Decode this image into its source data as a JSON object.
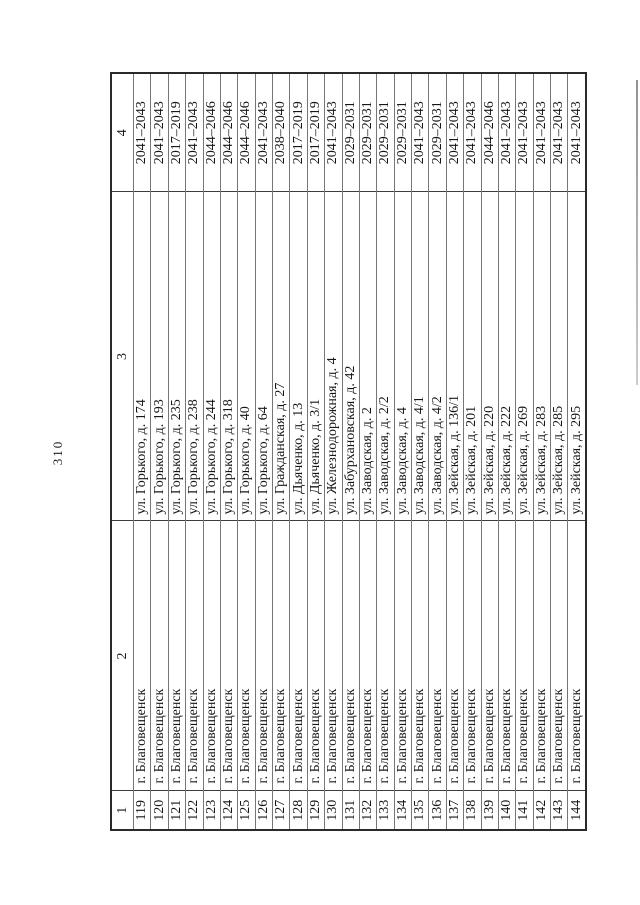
{
  "page": {
    "number": "310"
  },
  "table": {
    "column_numbers": [
      "1",
      "2",
      "3",
      "4"
    ],
    "rows": [
      {
        "num": "119",
        "city": "г. Благовещенск",
        "address": "ул. Горького, д. 174",
        "years": "2041–2043"
      },
      {
        "num": "120",
        "city": "г. Благовещенск",
        "address": "ул. Горького, д. 193",
        "years": "2041–2043"
      },
      {
        "num": "121",
        "city": "г. Благовещенск",
        "address": "ул. Горького, д. 235",
        "years": "2017–2019"
      },
      {
        "num": "122",
        "city": "г. Благовещенск",
        "address": "ул. Горького, д. 238",
        "years": "2041–2043"
      },
      {
        "num": "123",
        "city": "г. Благовещенск",
        "address": "ул. Горького, д. 244",
        "years": "2044–2046"
      },
      {
        "num": "124",
        "city": "г. Благовещенск",
        "address": "ул. Горького, д. 318",
        "years": "2044–2046"
      },
      {
        "num": "125",
        "city": "г. Благовещенск",
        "address": "ул. Горького, д. 40",
        "years": "2044–2046"
      },
      {
        "num": "126",
        "city": "г. Благовещенск",
        "address": "ул. Горького, д. 64",
        "years": "2041–2043"
      },
      {
        "num": "127",
        "city": "г. Благовещенск",
        "address": "ул. Гражданская, д. 27",
        "years": "2038–2040"
      },
      {
        "num": "128",
        "city": "г. Благовещенск",
        "address": "ул. Дьяченко, д. 13",
        "years": "2017–2019"
      },
      {
        "num": "129",
        "city": "г. Благовещенск",
        "address": "ул. Дьяченко, д. 3/1",
        "years": "2017–2019"
      },
      {
        "num": "130",
        "city": "г. Благовещенск",
        "address": "ул. Железнодорожная, д. 4",
        "years": "2041–2043"
      },
      {
        "num": "131",
        "city": "г. Благовещенск",
        "address": "ул. Забурхановская, д. 42",
        "years": "2029–2031"
      },
      {
        "num": "132",
        "city": "г. Благовещенск",
        "address": "ул. Заводская, д. 2",
        "years": "2029–2031"
      },
      {
        "num": "133",
        "city": "г. Благовещенск",
        "address": "ул. Заводская, д. 2/2",
        "years": "2029–2031"
      },
      {
        "num": "134",
        "city": "г. Благовещенск",
        "address": "ул. Заводская, д. 4",
        "years": "2029–2031"
      },
      {
        "num": "135",
        "city": "г. Благовещенск",
        "address": "ул. Заводская, д. 4/1",
        "years": "2041–2043"
      },
      {
        "num": "136",
        "city": "г. Благовещенск",
        "address": "ул. Заводская, д. 4/2",
        "years": "2029–2031"
      },
      {
        "num": "137",
        "city": "г. Благовещенск",
        "address": "ул. Зейская, д. 136/1",
        "years": "2041–2043"
      },
      {
        "num": "138",
        "city": "г. Благовещенск",
        "address": "ул. Зейская, д. 201",
        "years": "2041–2043"
      },
      {
        "num": "139",
        "city": "г. Благовещенск",
        "address": "ул. Зейская, д. 220",
        "years": "2044–2046"
      },
      {
        "num": "140",
        "city": "г. Благовещенск",
        "address": "ул. Зейская, д. 222",
        "years": "2041–2043"
      },
      {
        "num": "141",
        "city": "г. Благовещенск",
        "address": "ул. Зейская, д. 269",
        "years": "2041–2043"
      },
      {
        "num": "142",
        "city": "г. Благовещенск",
        "address": "ул. Зейская, д. 283",
        "years": "2041–2043"
      },
      {
        "num": "143",
        "city": "г. Благовещенск",
        "address": "ул. Зейская, д. 285",
        "years": "2041–2043"
      },
      {
        "num": "144",
        "city": "г. Благовещенск",
        "address": "ул. Зейская, д. 295",
        "years": "2041–2043"
      }
    ]
  }
}
